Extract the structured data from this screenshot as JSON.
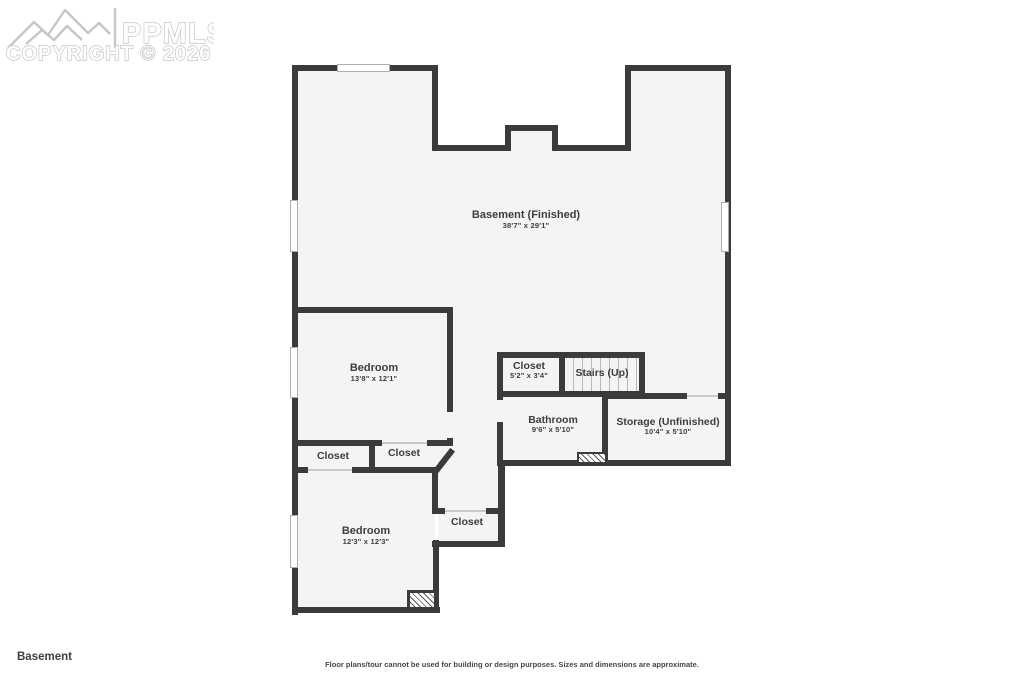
{
  "watermark": {
    "brand": "PPMLS",
    "copyright": "COPYRIGHT © 2026"
  },
  "floor_label": "Basement",
  "disclaimer": "Floor plans/tour cannot be used for building or design purposes. Sizes and dimensions are approximate.",
  "rooms": [
    {
      "name": "Basement (Finished)",
      "dims": "38'7\" x 29'1\""
    },
    {
      "name": "Bedroom",
      "dims": "13'8\" x 12'1\""
    },
    {
      "name": "Closet",
      "dims": "5'2\" x 3'4\""
    },
    {
      "name": "Stairs (Up)",
      "dims": ""
    },
    {
      "name": "Bathroom",
      "dims": "9'6\" x 5'10\""
    },
    {
      "name": "Storage (Unfinished)",
      "dims": "10'4\" x 5'10\""
    },
    {
      "name": "Closet",
      "dims": ""
    },
    {
      "name": "Closet",
      "dims": ""
    },
    {
      "name": "Bedroom",
      "dims": "12'3\" x 12'3\""
    },
    {
      "name": "Closet",
      "dims": ""
    }
  ],
  "colors": {
    "wall": "#3b3b3b",
    "room_fill": "#f4f4f4",
    "label_text": "#3d3d3d",
    "window_border": "#aeaeae",
    "watermark_outline": "#c6c6c6"
  }
}
